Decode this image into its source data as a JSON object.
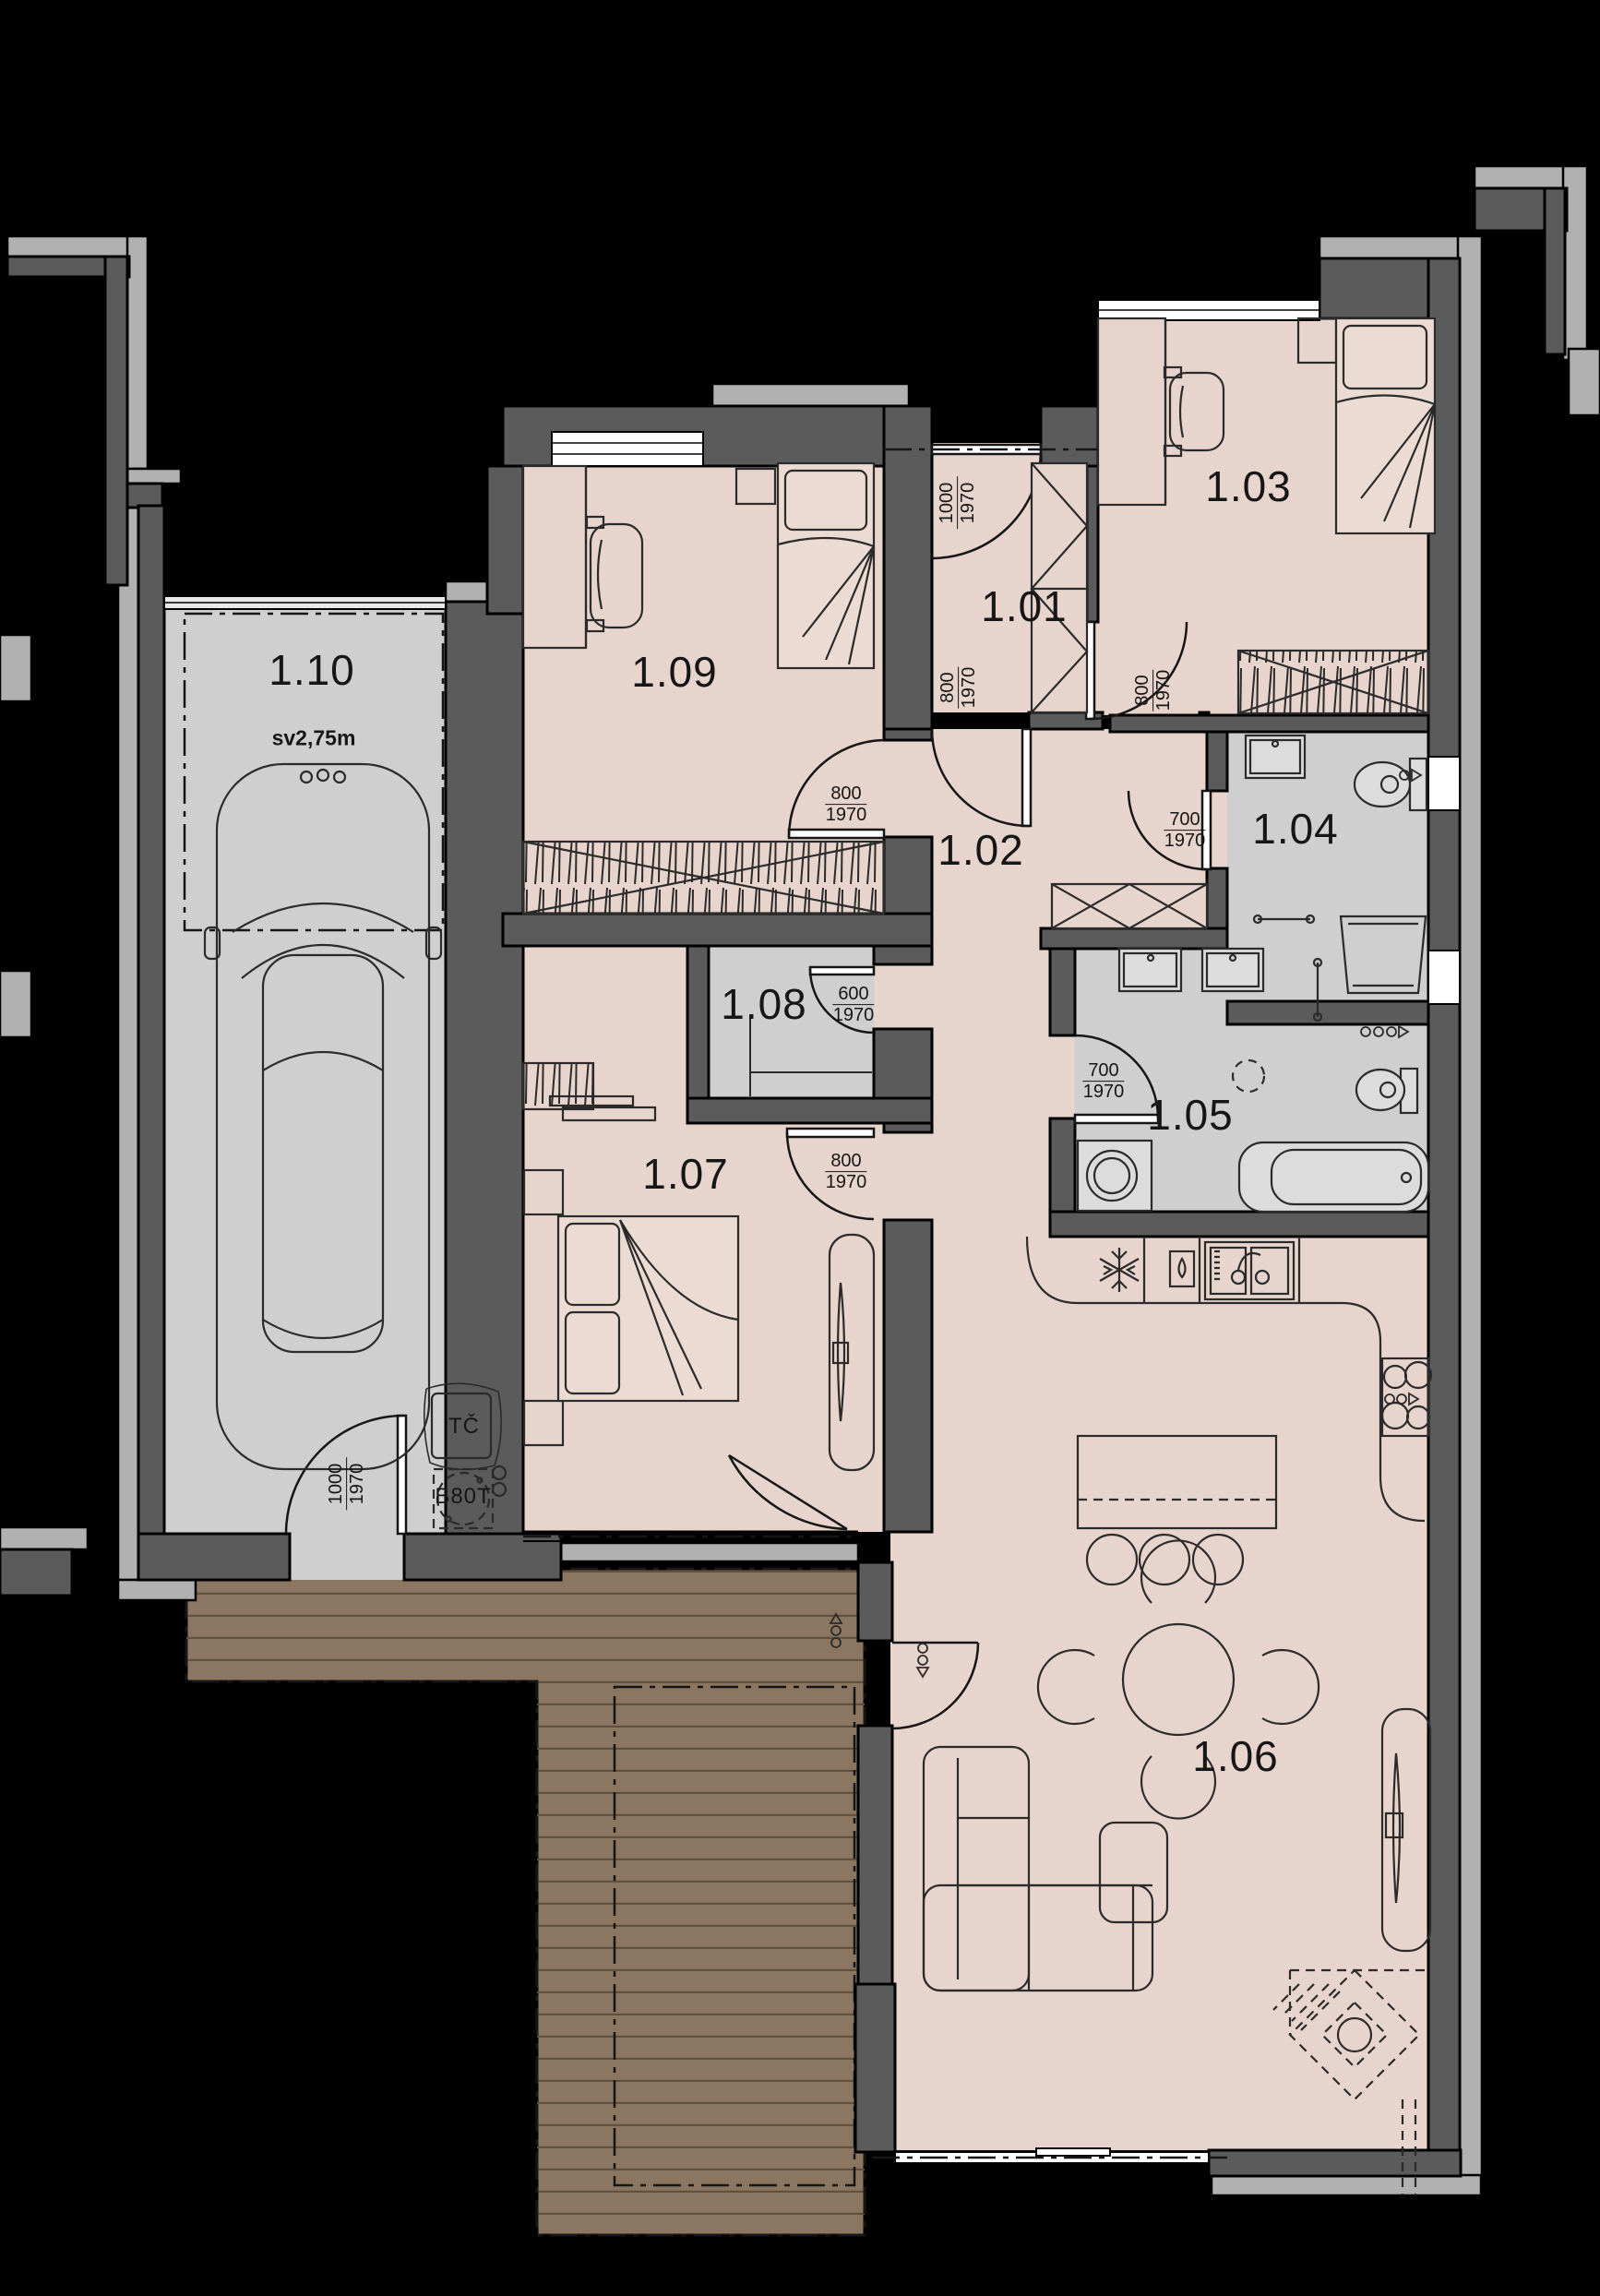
{
  "rooms": {
    "r101": "1.01",
    "r102": "1.02",
    "r103": "1.03",
    "r104": "1.04",
    "r105": "1.05",
    "r106": "1.06",
    "r107": "1.07",
    "r108": "1.08",
    "r109": "1.09",
    "r110": "1.10"
  },
  "annotations": {
    "clear_height": "sv2,75m",
    "heat_pump": "TČ",
    "boiler": "B80T"
  },
  "doors": {
    "entry": {
      "w": "1000",
      "h": "1970"
    },
    "d101": {
      "w": "800",
      "h": "1970"
    },
    "d103": {
      "w": "800",
      "h": "1970"
    },
    "d109": {
      "w": "800",
      "h": "1970"
    },
    "d104": {
      "w": "700",
      "h": "1970"
    },
    "d105": {
      "w": "700",
      "h": "1970"
    },
    "d108": {
      "w": "600",
      "h": "1970"
    },
    "d107": {
      "w": "800",
      "h": "1970"
    },
    "garage_exit": {
      "w": "1000",
      "h": "1970"
    }
  },
  "colors": {
    "background": "#000000",
    "wall": "#5b5b5b",
    "trim": "#b1b1b1",
    "floor_warm": "#e7d4cc",
    "floor_wet": "#cfcfcf",
    "terrace": "#8b7661",
    "line": "#1c1c1c"
  }
}
